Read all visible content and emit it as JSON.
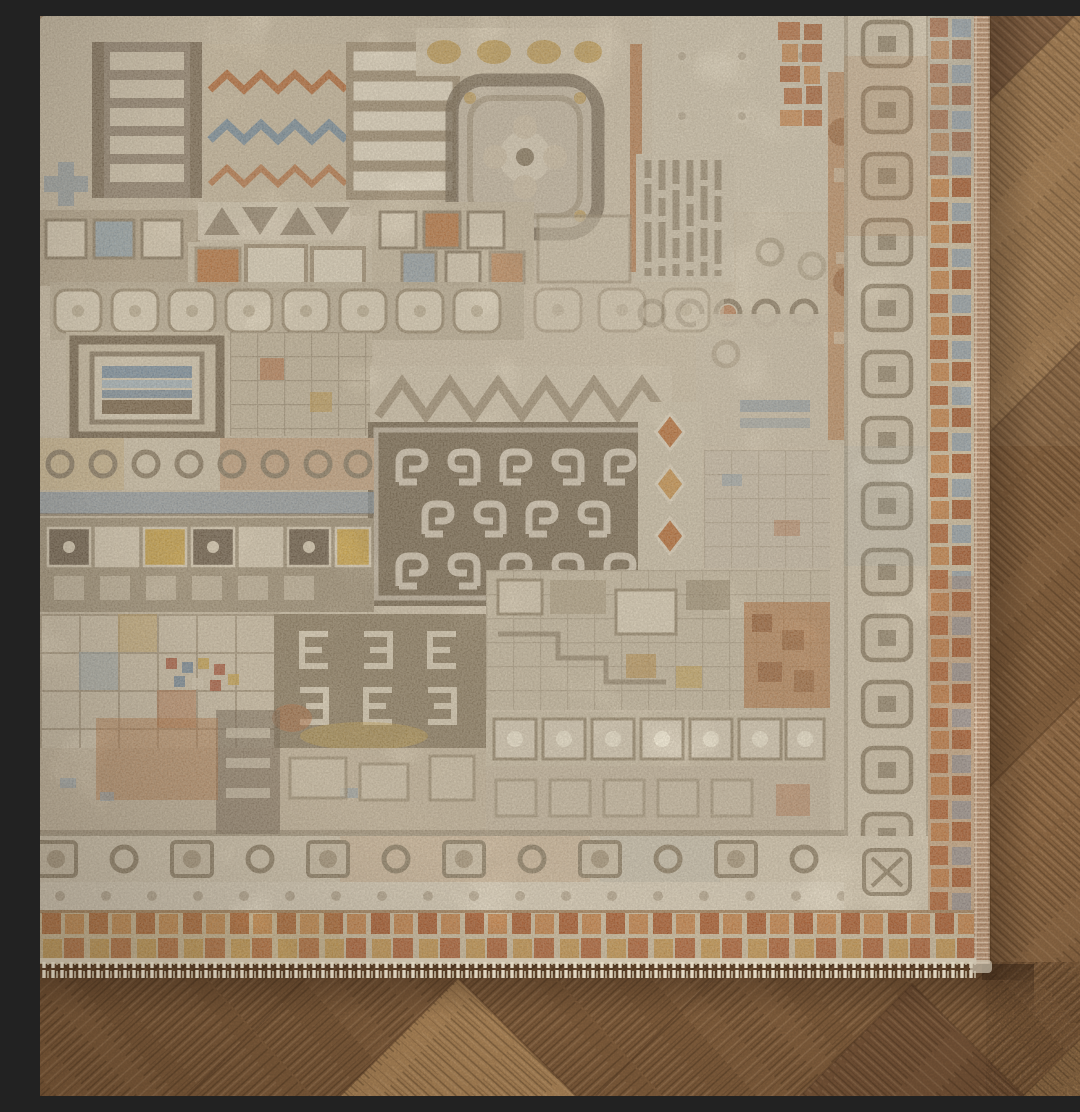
{
  "scene": {
    "type": "photograph",
    "aria_label": "Corner of an ornate distressed oriental-style area rug on a herringbone wood parquet floor",
    "description": "Close-up photograph of the corner of a vintage-style patchwork area rug covering the upper-left of the frame. The rug field is a dense mosaic of faded geometric panels: ladders of cream bars, orange and slate-blue zigzag chevrons, a rosette medallion, a brown square medallion filled with cream scroll glyphs, rows of rounded cream squares, ring motifs, tile grids, hook motifs and small checkered mosaics, accented in rust orange, ochre gold and gray blue. The rug is framed by a cream inner border with ring-in-square motifs, a rust-orange mosaic outer border, a pink-tan bound selvage on the right edge and short cream fringe along the bottom edge. Medium-brown herringbone wood flooring with visible diagonal grain fills the right side and bottom of the frame, with a soft shadow cast by the rug edge.",
    "objects": {
      "rug": "distressed patchwork area rug corner",
      "rug_field": "geometric patchwork field panels",
      "inner_border": "cream border with ring and square motifs",
      "outer_border": "rust-orange mosaic border",
      "selvage": "pink-tan bound rug edge",
      "fringe": "short cream fringe tassels",
      "floor": "herringbone wood parquet",
      "shadow": "contact shadow under rug edges"
    },
    "palette": {
      "wood_base": "#85613f",
      "wood_light": "#b28a5c",
      "wood_dark": "#6e4e33",
      "rug_cream": "#d8cdb8",
      "rug_cream_light": "#e4dbc8",
      "rug_taupe": "#8e8170",
      "rug_brown": "#7c6e59",
      "rug_rust": "#b4673a",
      "rug_copper": "#c8854d",
      "rug_gold": "#c09a4e",
      "rug_blue": "#7f95a8",
      "selvage_pink": "#c49a7a",
      "fringe_cream": "#e9dfca"
    }
  }
}
